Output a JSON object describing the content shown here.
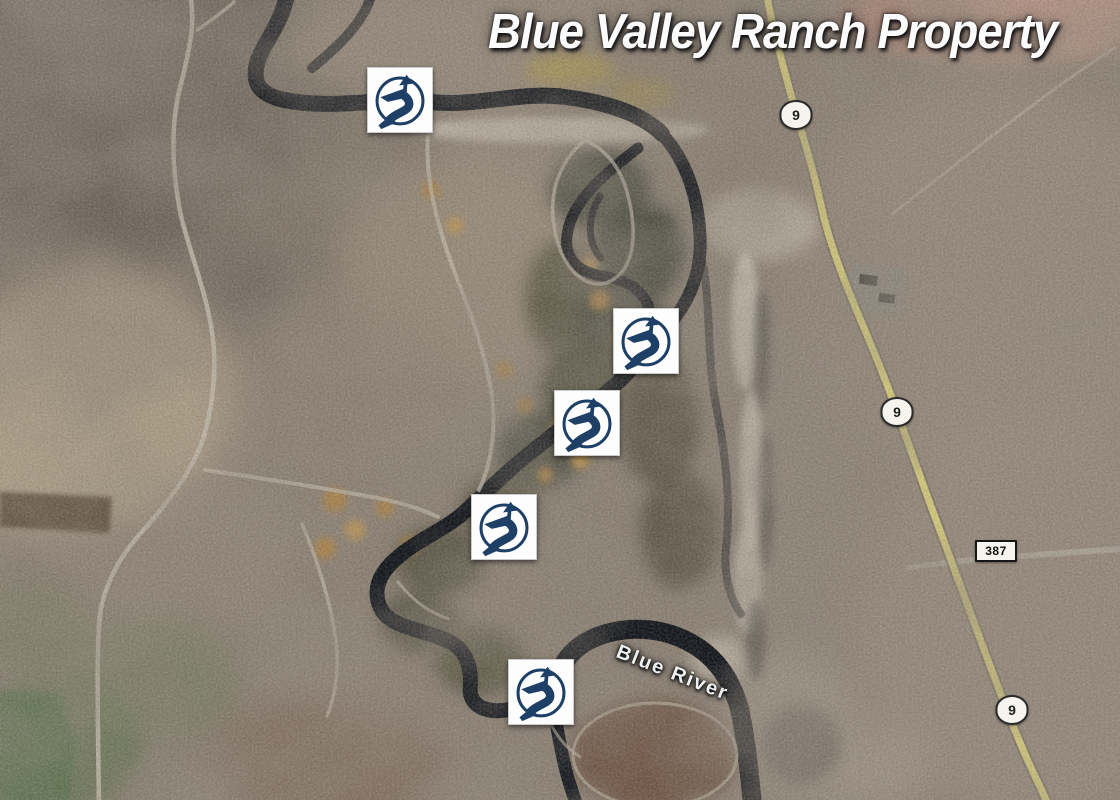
{
  "map": {
    "title": "Blue Valley Ranch Property",
    "river_label": "Blue River",
    "highway_shields": [
      {
        "label": "9",
        "x": 796,
        "y": 115
      },
      {
        "label": "9",
        "x": 897,
        "y": 412
      },
      {
        "label": "9",
        "x": 1012,
        "y": 710
      }
    ],
    "road_plates": [
      {
        "label": "387",
        "x": 996,
        "y": 551
      }
    ],
    "access_markers": [
      {
        "id": "river-access-1",
        "x": 400,
        "y": 100
      },
      {
        "id": "river-access-2",
        "x": 646,
        "y": 341
      },
      {
        "id": "river-access-3",
        "x": 587,
        "y": 423
      },
      {
        "id": "river-access-4",
        "x": 504,
        "y": 527
      },
      {
        "id": "river-access-5",
        "x": 541,
        "y": 692
      }
    ],
    "colors": {
      "marker_navy": "#1e3f66",
      "highway_yellow": "#d9ce7d",
      "river_dark": "#0a0e15",
      "title_white": "#fbfbfb"
    }
  }
}
